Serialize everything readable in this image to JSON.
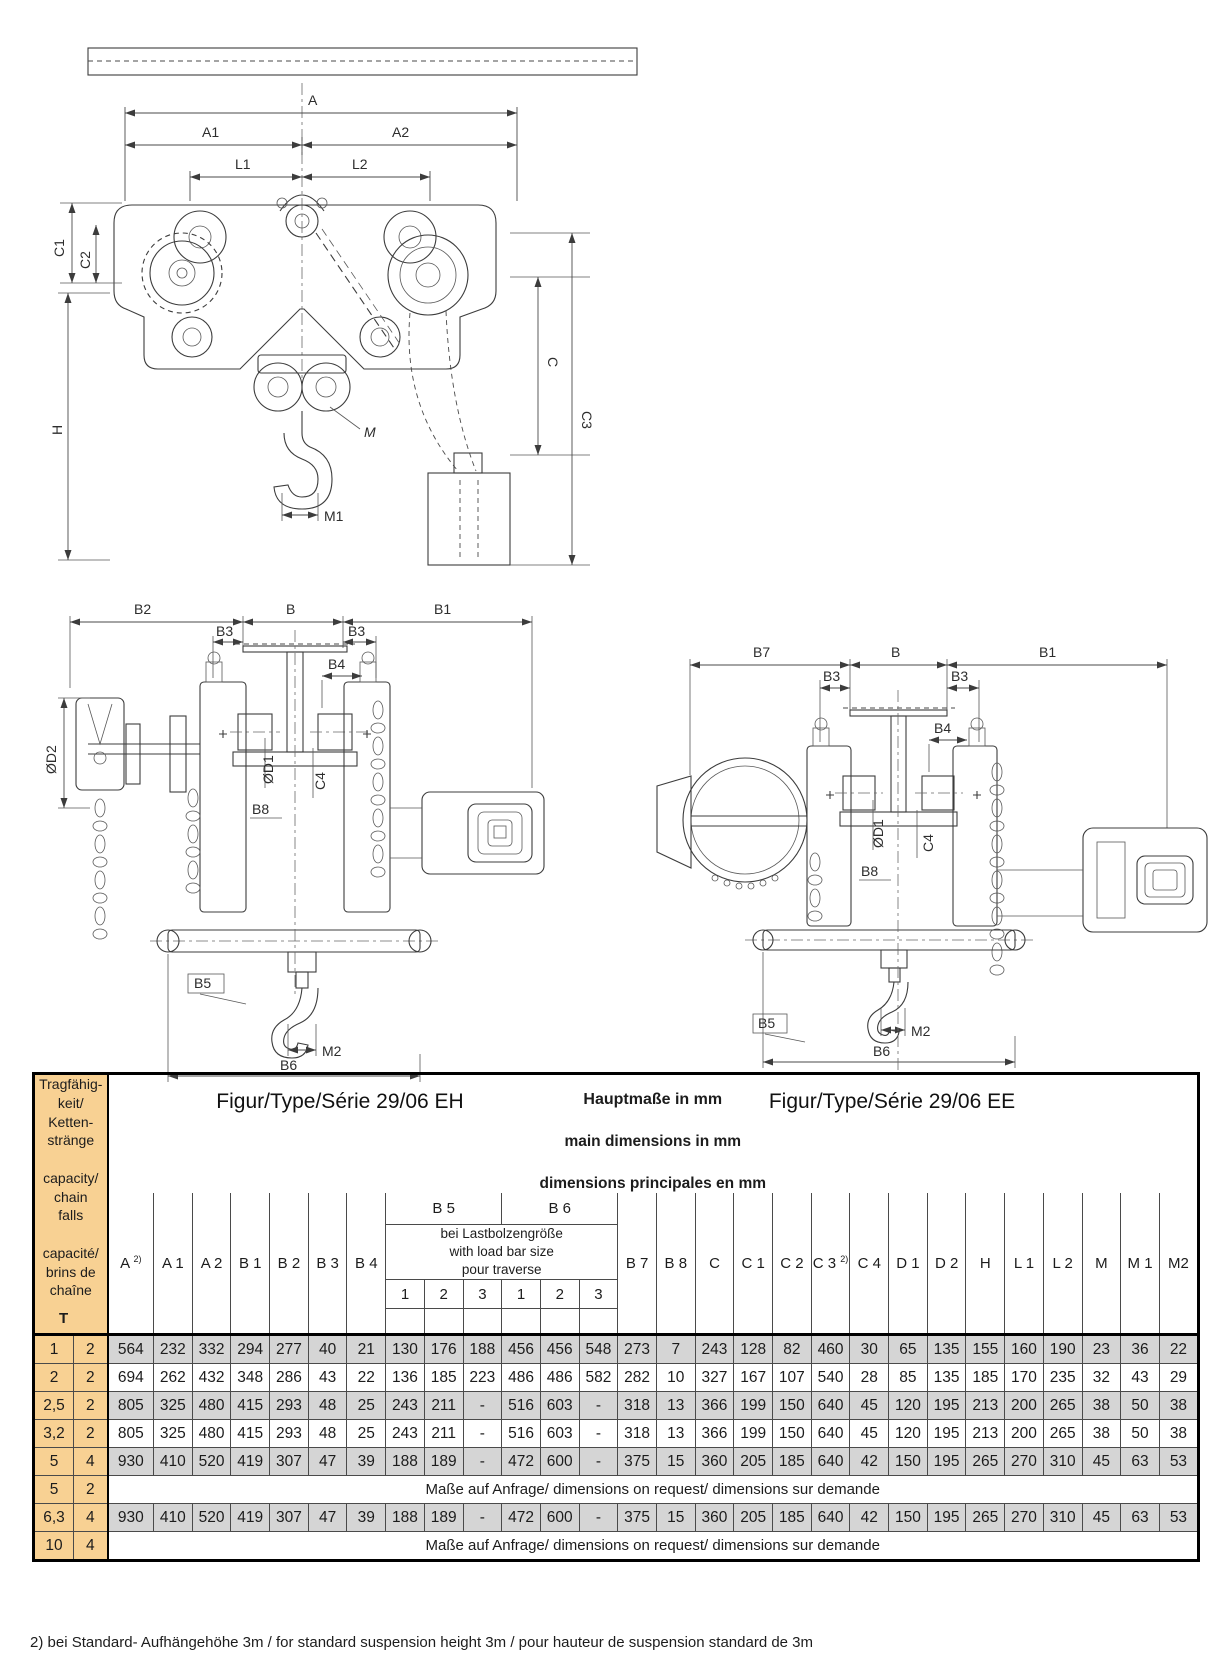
{
  "figures": {
    "top": {
      "labels": {
        "a": "A",
        "a1": "A1",
        "a2": "A2",
        "l1": "L1",
        "l2": "L2",
        "c1": "C1",
        "c2": "C2",
        "h": "H",
        "c": "C",
        "c3": "C3",
        "m": "M",
        "m1": "M1"
      }
    },
    "eh": {
      "caption": "Figur/Type/Série 29/06 EH",
      "labels": {
        "b2": "B2",
        "b": "B",
        "b1": "B1",
        "b3_left": "B3",
        "b3_right": "B3",
        "b4": "B4",
        "d2": "ØD2",
        "d1": "ØD1",
        "c4": "C4",
        "b8": "B8",
        "b5": "B5",
        "m2": "M2",
        "b6": "B6"
      }
    },
    "ee": {
      "caption": "Figur/Type/Série 29/06 EE",
      "labels": {
        "b7": "B7",
        "b": "B",
        "b1": "B1",
        "b3_left": "B3",
        "b3_right": "B3",
        "b4": "B4",
        "d1": "ØD1",
        "c4": "C4",
        "b8": "B8",
        "b5": "B5",
        "m2": "M2",
        "b6": "B6"
      }
    }
  },
  "table": {
    "capacity_header": {
      "text": "Tragfähig-\nkeit/\nKetten-\nstränge\n\ncapacity/\nchain\nfalls\n\ncapacité/\nbrins de\nchaîne",
      "t_label": "T"
    },
    "title_lines": [
      "Hauptmaße  in mm",
      "main dimensions in mm",
      "dimensions principales en mm"
    ],
    "columns_left": [
      {
        "label": "A ",
        "sup": "2)"
      },
      {
        "label": "A 1",
        "sup": ""
      },
      {
        "label": "A 2",
        "sup": ""
      },
      {
        "label": "B 1",
        "sup": ""
      },
      {
        "label": "B 2",
        "sup": ""
      },
      {
        "label": "B 3",
        "sup": ""
      },
      {
        "label": "B 4",
        "sup": ""
      }
    ],
    "load_bar_group": {
      "b5_label": "B 5",
      "b6_label": "B 6",
      "description": "bei Lastbolzengröße\nwith load bar size\npour traverse",
      "subcolumns": [
        "1",
        "2",
        "3",
        "1",
        "2",
        "3"
      ]
    },
    "columns_right": [
      {
        "label": "B 7",
        "sup": ""
      },
      {
        "label": "B 8",
        "sup": ""
      },
      {
        "label": "C",
        "sup": ""
      },
      {
        "label": "C 1",
        "sup": ""
      },
      {
        "label": "C 2",
        "sup": ""
      },
      {
        "label": "C 3 ",
        "sup": "2)"
      },
      {
        "label": "C 4",
        "sup": ""
      },
      {
        "label": "D 1",
        "sup": ""
      },
      {
        "label": "D 2",
        "sup": ""
      },
      {
        "label": "H",
        "sup": ""
      },
      {
        "label": "L 1",
        "sup": ""
      },
      {
        "label": "L 2",
        "sup": ""
      },
      {
        "label": "M",
        "sup": ""
      },
      {
        "label": "M 1",
        "sup": ""
      },
      {
        "label": "M2",
        "sup": ""
      }
    ],
    "request_text": "Maße auf Anfrage/ dimensions on request/ dimensions sur demande",
    "rows": [
      {
        "capacity": "1",
        "falls": "2",
        "shaded": true,
        "values": [
          "564",
          "232",
          "332",
          "294",
          "277",
          "40",
          "21",
          "130",
          "176",
          "188",
          "456",
          "456",
          "548",
          "273",
          "7",
          "243",
          "128",
          "82",
          "460",
          "30",
          "65",
          "135",
          "155",
          "160",
          "190",
          "23",
          "36",
          "22"
        ]
      },
      {
        "capacity": "2",
        "falls": "2",
        "shaded": false,
        "values": [
          "694",
          "262",
          "432",
          "348",
          "286",
          "43",
          "22",
          "136",
          "185",
          "223",
          "486",
          "486",
          "582",
          "282",
          "10",
          "327",
          "167",
          "107",
          "540",
          "28",
          "85",
          "135",
          "185",
          "170",
          "235",
          "32",
          "43",
          "29"
        ]
      },
      {
        "capacity": "2,5",
        "falls": "2",
        "shaded": true,
        "values": [
          "805",
          "325",
          "480",
          "415",
          "293",
          "48",
          "25",
          "243",
          "211",
          "-",
          "516",
          "603",
          "-",
          "318",
          "13",
          "366",
          "199",
          "150",
          "640",
          "45",
          "120",
          "195",
          "213",
          "200",
          "265",
          "38",
          "50",
          "38"
        ]
      },
      {
        "capacity": "3,2",
        "falls": "2",
        "shaded": false,
        "values": [
          "805",
          "325",
          "480",
          "415",
          "293",
          "48",
          "25",
          "243",
          "211",
          "-",
          "516",
          "603",
          "-",
          "318",
          "13",
          "366",
          "199",
          "150",
          "640",
          "45",
          "120",
          "195",
          "213",
          "200",
          "265",
          "38",
          "50",
          "38"
        ]
      },
      {
        "capacity": "5",
        "falls": "4",
        "shaded": true,
        "values": [
          "930",
          "410",
          "520",
          "419",
          "307",
          "47",
          "39",
          "188",
          "189",
          "-",
          "472",
          "600",
          "-",
          "375",
          "15",
          "360",
          "205",
          "185",
          "640",
          "42",
          "150",
          "195",
          "265",
          "270",
          "310",
          "45",
          "63",
          "53"
        ]
      },
      {
        "capacity": "5",
        "falls": "2",
        "shaded": false,
        "request": true
      },
      {
        "capacity": "6,3",
        "falls": "4",
        "shaded": true,
        "values": [
          "930",
          "410",
          "520",
          "419",
          "307",
          "47",
          "39",
          "188",
          "189",
          "-",
          "472",
          "600",
          "-",
          "375",
          "15",
          "360",
          "205",
          "185",
          "640",
          "42",
          "150",
          "195",
          "265",
          "270",
          "310",
          "45",
          "63",
          "53"
        ]
      },
      {
        "capacity": "10",
        "falls": "4",
        "shaded": false,
        "request": true
      }
    ]
  },
  "footnote": "2) bei Standard- Aufhängehöhe 3m / for standard suspension height 3m / pour hauteur de suspension standard de 3m",
  "colors": {
    "capacity_bg": "#F8D193",
    "shaded_row_bg": "#D5D5D5"
  }
}
